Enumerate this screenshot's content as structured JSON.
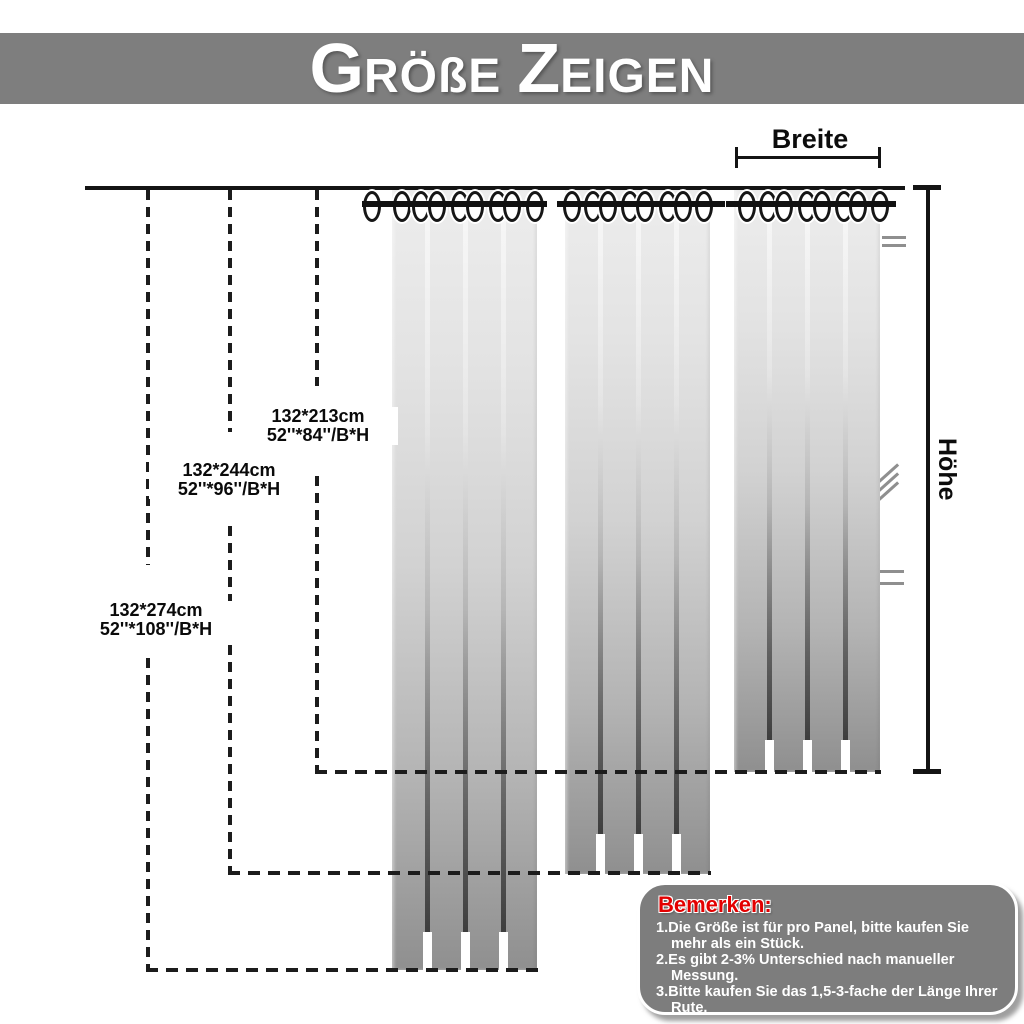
{
  "header": {
    "word1": {
      "initial": "G",
      "rest": "RÖßE"
    },
    "word2": {
      "initial": "Z",
      "rest": "EIGEN"
    }
  },
  "measurements": {
    "width_label": "Breite",
    "height_label": "Höhe"
  },
  "sizes": [
    {
      "cm": "132*213cm",
      "inch": "52''*84''/B*H"
    },
    {
      "cm": "132*244cm",
      "inch": "52''*96''/B*H"
    },
    {
      "cm": "132*274cm",
      "inch": "52''*108''/B*H"
    }
  ],
  "notes": {
    "title": "Bemerken:",
    "items": [
      "1.Die Größe ist für pro Panel, bitte kaufen Sie mehr als ein Stück.",
      "2.Es gibt 2-3% Unterschied nach manueller Messung.",
      "3.Bitte kaufen Sie das 1,5-3-fache der Länge Ihrer Rute."
    ]
  },
  "colors": {
    "banner": "#7e7e7e",
    "note_box": "#7d7d7d",
    "note_title": "#e30000",
    "curtain_top": "#ededed",
    "curtain_bottom": "#8f8f8f"
  }
}
